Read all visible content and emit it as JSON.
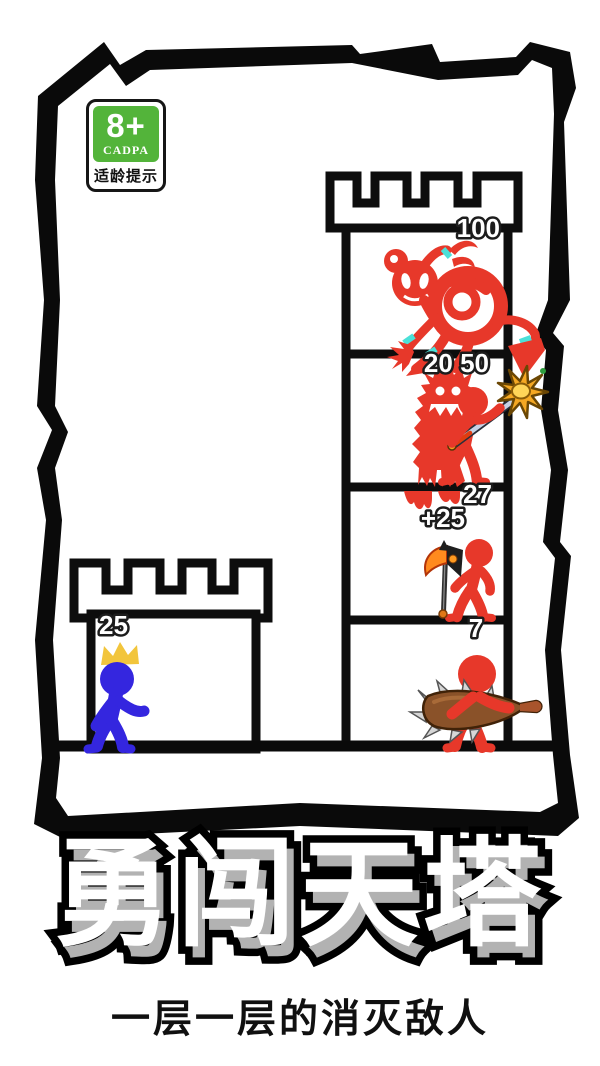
{
  "title": "勇闯天塔",
  "subtitle": "一层一层的消灭敌人",
  "age_badge": {
    "rating": "8+",
    "org": "CADPA",
    "label": "适龄提示"
  },
  "colors": {
    "enemy_red": "#e7382a",
    "player_blue": "#3426df",
    "accent_cyan": "#4be0d8",
    "crown_gold": "#f2c53c",
    "badge_green": "#53b43a",
    "mace_gold": "#f5a823",
    "club_brown": "#8a5229",
    "outline_black": "#0d0d0d"
  },
  "scene": {
    "player_tower": {
      "hp": "25",
      "unit": "blue-king-stickman"
    },
    "enemy_tower": {
      "floors": [
        {
          "hp": "100",
          "enemy": "red-spider-girl-monster"
        },
        {
          "hp": "20 50",
          "enemy": "red-furry-monster-and-stickman-with-mace"
        },
        {
          "hp": "27",
          "bonus": "+25",
          "enemy": "red-stickman-with-battle-axe"
        },
        {
          "hp": "7",
          "enemy": "red-stickman-with-spiked-club"
        }
      ]
    }
  }
}
